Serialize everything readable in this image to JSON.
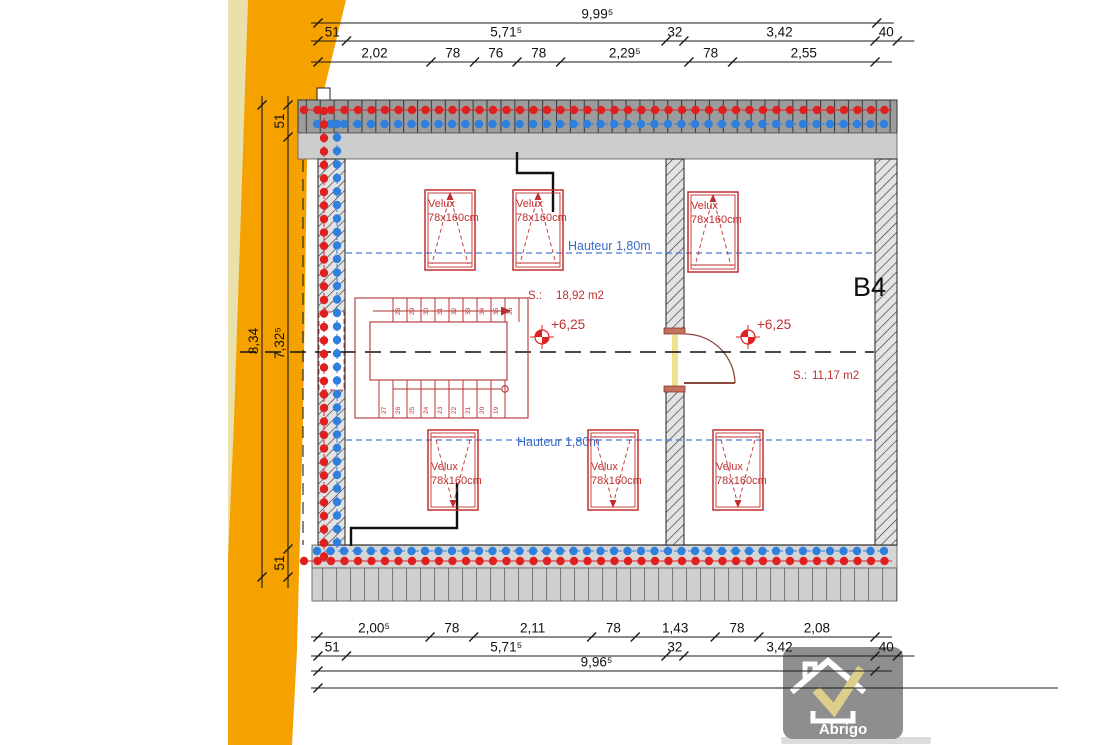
{
  "plan": {
    "velux": {
      "label": "Velux",
      "size": "78x160cm"
    },
    "hauteur_label": "Hauteur 1,80m",
    "level_label": "+6,25",
    "room1_area": {
      "prefix": "S.:",
      "value": "18,92 m2"
    },
    "room2_area": {
      "prefix": "S.:",
      "value": "11,17 m2"
    },
    "section_label": "B4",
    "stairs": {
      "top_numbers": [
        "28",
        "29",
        "30",
        "31",
        "32",
        "33",
        "34",
        "35",
        "36"
      ],
      "bottom_numbers": [
        "27",
        "26",
        "25",
        "24",
        "23",
        "22",
        "21",
        "20",
        "19"
      ]
    }
  },
  "dimensions": {
    "top_rows": [
      {
        "segments": [
          {
            "label": "9,99⁵",
            "m": 9.995
          }
        ]
      },
      {
        "segments": [
          {
            "label": "51",
            "m": 0.51
          },
          {
            "label": "5,71⁵",
            "m": 5.715
          },
          {
            "label": "32",
            "m": 0.32
          },
          {
            "label": "3,42",
            "m": 3.42
          },
          {
            "label": "40",
            "m": 0.4
          }
        ]
      },
      {
        "segments": [
          {
            "label": "2,02",
            "m": 2.02
          },
          {
            "label": "78",
            "m": 0.78
          },
          {
            "label": "76",
            "m": 0.76
          },
          {
            "label": "78",
            "m": 0.78
          },
          {
            "label": "2,29⁵",
            "m": 2.295
          },
          {
            "label": "78",
            "m": 0.78
          },
          {
            "label": "2,55",
            "m": 2.55
          }
        ]
      }
    ],
    "bottom_rows": [
      {
        "segments": [
          {
            "label": "2,00⁵",
            "m": 2.005
          },
          {
            "label": "78",
            "m": 0.78
          },
          {
            "label": "2,11",
            "m": 2.11
          },
          {
            "label": "78",
            "m": 0.78
          },
          {
            "label": "1,43",
            "m": 1.43
          },
          {
            "label": "78",
            "m": 0.78
          },
          {
            "label": "2,08",
            "m": 2.08
          }
        ]
      },
      {
        "segments": [
          {
            "label": "51",
            "m": 0.51
          },
          {
            "label": "5,71⁵",
            "m": 5.715
          },
          {
            "label": "32",
            "m": 0.32
          },
          {
            "label": "3,42",
            "m": 3.42
          },
          {
            "label": "40",
            "m": 0.4
          }
        ]
      },
      {
        "segments": [
          {
            "label": "9,96⁵",
            "m": 9.965
          }
        ]
      }
    ],
    "left": [
      "51",
      "8,34",
      "7,32⁵",
      "51"
    ]
  },
  "logo": {
    "name": "Abrigo"
  },
  "colors": {
    "accent_orange": "#F5A201",
    "accent_orange_pale": "#EAE0AC",
    "dot_red": "#E02020",
    "dot_blue": "#2E7FDE",
    "line_red": "#C03030",
    "line_blue": "#4472C4",
    "ink": "#1a1a1a"
  }
}
